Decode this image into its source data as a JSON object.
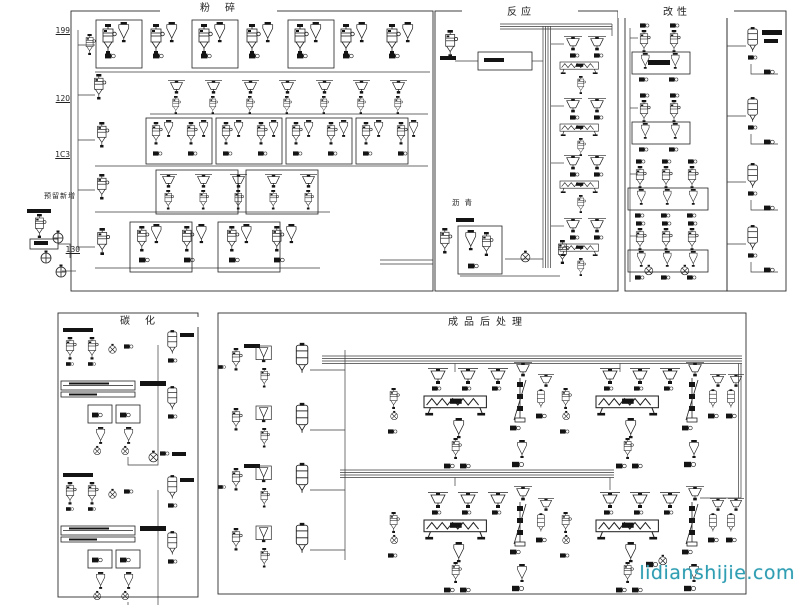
{
  "sections": {
    "fensui": {
      "title": "粉碎"
    },
    "fanying": {
      "title": "反应"
    },
    "gaixing": {
      "title": "改性"
    },
    "tanhua": {
      "title": "碳化"
    },
    "chengpin": {
      "title": "成品后处理"
    }
  },
  "labels": {
    "row1": "199",
    "row2": "120",
    "row3": "1C3",
    "reserved": "预留新增",
    "row4": "130",
    "asphalt": "沥青"
  },
  "watermark": {
    "text": "lidianshijie.com"
  },
  "colors": {
    "background": "#ffffff",
    "line": "#222222",
    "watermark": "#2f9db2"
  },
  "icons": {
    "legend": "process-flow-diagram symbols: column-unit, cyclone, cyclone-box, hopper, vibrating-screen, rotary-furnace, blower, tank, bucket-elevator, motor, pump"
  }
}
